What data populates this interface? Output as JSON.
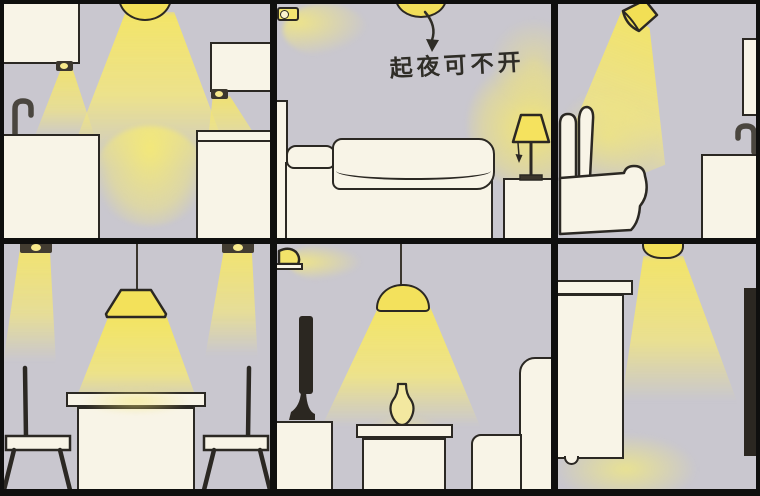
{
  "caption": {
    "bedroom_note": "起夜可不开"
  },
  "palette": {
    "wall": "#c9c7cf",
    "outline": "#2b2823",
    "panel_border": "#0f0f0e",
    "furniture_cream": "#f8f4e7",
    "lamp_yellow": "#f2df58",
    "light_beam_yellow": "#f0e57d",
    "dark_object": "#2b2721",
    "metal_gray": "#57534b"
  },
  "panels": [
    {
      "room": "kitchen"
    },
    {
      "room": "bedroom"
    },
    {
      "room": "bathroom-toilet"
    },
    {
      "room": "dining-room"
    },
    {
      "room": "living-room"
    },
    {
      "room": "utility-room"
    }
  ]
}
